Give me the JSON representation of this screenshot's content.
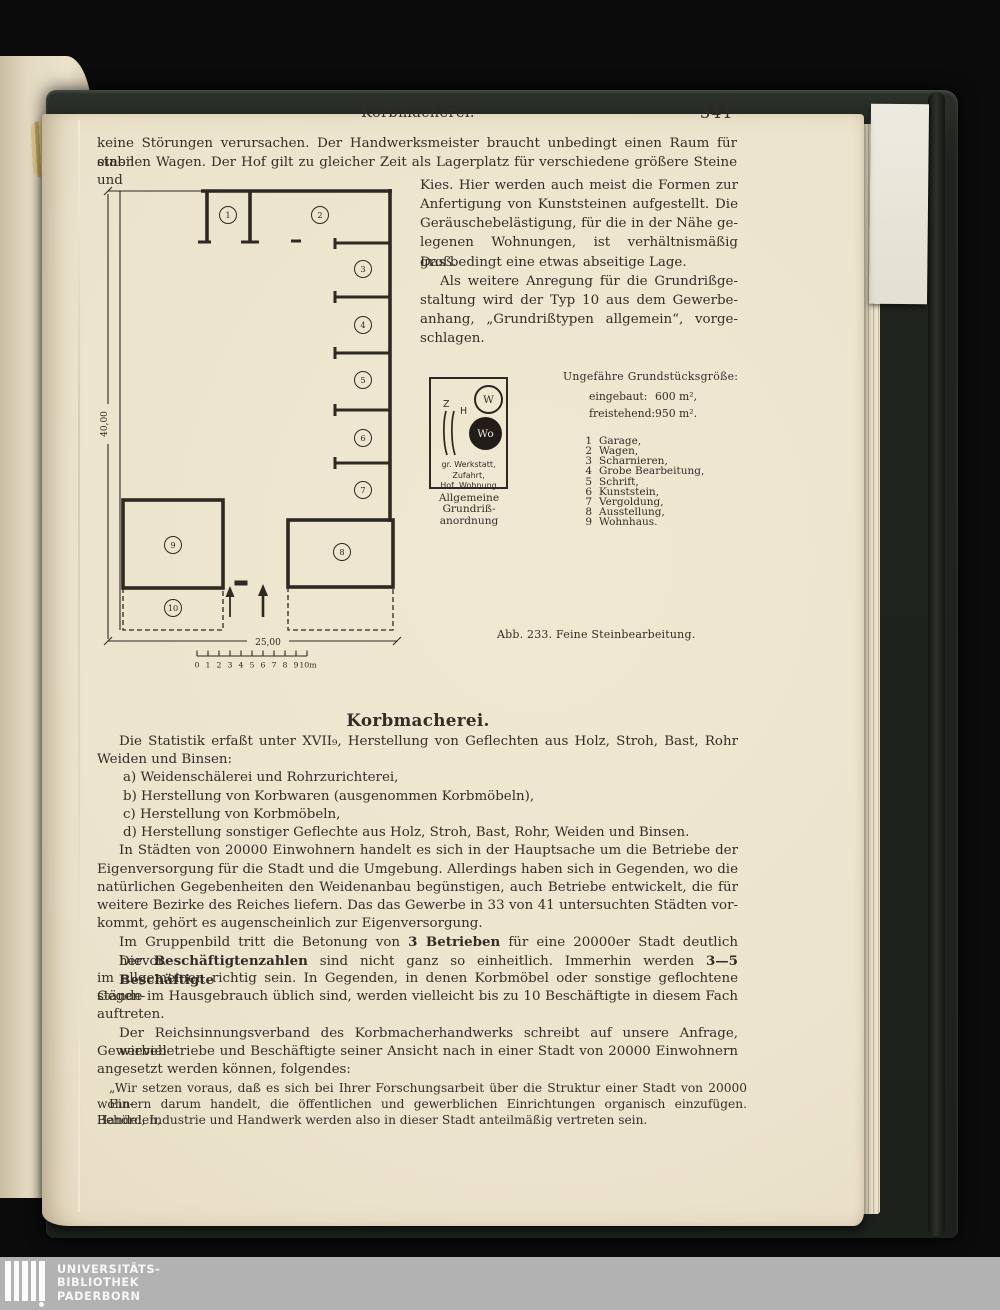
{
  "page": {
    "running_head": "Korbmacherei.",
    "page_number": "341"
  },
  "body": {
    "intro": [
      "keine Störungen verursachen.  Der Handwerksmeister braucht unbedingt einen Raum für einen",
      "stabilen Wagen.  Der Hof gilt zu gleicher Zeit als Lagerplatz für verschiedene größere Steine und"
    ],
    "column": [
      "Kies.  Hier werden auch meist die Formen zur",
      "Anfertigung von Kunststeinen aufgestellt.  Die",
      "Geräuschebelästigung, für die in der Nähe ge-",
      "legenen Wohnungen, ist verhältnismäßig groß.",
      "Das bedingt eine etwas abseitige Lage.",
      "Als weitere Anregung für die Grundrißge-",
      "staltung wird der Typ 10 aus dem Gewerbe-",
      "anhang, „Grundrißtypen allgemein“, vorge-",
      "schlagen."
    ],
    "section_heading": "Korbmacherei.",
    "l1": "Die Statistik erfaßt unter XVII₉, Herstellung von Geflechten aus Holz, Stroh, Bast, Rohr",
    "l2": "Weiden und Binsen:",
    "list_a": "a) Weidenschälerei und Rohrzurichterei,",
    "list_b": "b) Herstellung von Korbwaren (ausgenommen Korbmöbeln),",
    "list_c": "c) Herstellung von Korbmöbeln,",
    "list_d": "d) Herstellung sonstiger Geflechte aus Holz, Stroh, Bast, Rohr, Weiden und Binsen.",
    "p2": [
      "In Städten von 20000 Einwohnern handelt es sich in der Hauptsache um die Betriebe der",
      "Eigenversorgung für die Stadt und die Umgebung.  Allerdings haben sich in Gegenden, wo die",
      "natürlichen Gegebenheiten den Weidenanbau begünstigen, auch Betriebe entwickelt, die für",
      "weitere Bezirke des Reiches liefern.  Das das Gewerbe in 33 von 41 untersuchten Städten vor-",
      "kommt, gehört es augenscheinlich zur Eigenversorgung."
    ],
    "p3": {
      "s1": "Im Gruppenbild tritt die Betonung von ",
      "b1": "3 Betrieben",
      "s2": " für eine 20000er Stadt deutlich hervor."
    },
    "p4l1": {
      "s1": "Die ",
      "b1": "Beschäftigtenzahlen",
      "s2": " sind nicht ganz so einheitlich.  Immerhin werden ",
      "b2": "3—5 Beschäftigte"
    },
    "p4rest": [
      "im allgemeinen richtig sein.  In Gegenden, in denen Korbmöbel oder sonstige geflochtene Gegen-",
      "stände im Hausgebrauch üblich sind, werden vielleicht bis zu 10 Beschäftigte in diesem Fach",
      "auftreten."
    ],
    "p5": [
      "Der Reichsinnungsverband des Korbmacherhandwerks schreibt auf unsere Anfrage, wieviel",
      "Gewerbebetriebe und Beschäftigte seiner Ansicht nach in einer Stadt von 20000 Einwohnern",
      "angesetzt werden können, folgendes:"
    ],
    "quote": [
      "„Wir setzen voraus, daß es sich bei Ihrer Forschungsarbeit über die Struktur einer Stadt von 20000 Ein-",
      "wohnern darum handelt, die öffentlichen und gewerblichen Einrichtungen organisch einzufügen.  Behörden,",
      "Handel, Industrie und Handwerk werden also in dieser Stadt anteilmäßig vertreten sein."
    ]
  },
  "figure": {
    "plan": {
      "height_label": "40,00",
      "width_label": "25,00",
      "rooms": [
        "1",
        "2",
        "3",
        "4",
        "5",
        "6",
        "7",
        "8",
        "9",
        "10"
      ],
      "scale": [
        "0",
        "1",
        "2",
        "3",
        "4",
        "5",
        "6",
        "7",
        "8",
        "9",
        "10m"
      ]
    },
    "legend_box": {
      "z": "Z",
      "h": "H",
      "w": "W",
      "wo": "Wo",
      "caption1": "gr. Werkstatt, Zufahrt,",
      "caption2": "Hof, Wohnung",
      "title1": "Allgemeine",
      "title2": "Grundriß-",
      "title3": "anordnung"
    },
    "plot_info": {
      "title": "Ungefähre Grundstücksgröße:",
      "row1_label": "eingebaut:",
      "row1_value": "600 m²,",
      "row2_label": "freistehend:",
      "row2_value": "950 m²."
    },
    "legend_items": [
      {
        "num": "1",
        "label": "Garage,"
      },
      {
        "num": "2",
        "label": "Wagen,"
      },
      {
        "num": "3",
        "label": "Scharnieren,"
      },
      {
        "num": "4",
        "label": "Grobe Bearbeitung,"
      },
      {
        "num": "5",
        "label": "Schrift,"
      },
      {
        "num": "6",
        "label": "Kunststein,"
      },
      {
        "num": "7",
        "label": "Vergoldung,"
      },
      {
        "num": "8",
        "label": "Ausstellung,"
      },
      {
        "num": "9",
        "label": "Wohnhaus."
      }
    ],
    "caption": "Abb. 233.  Feine Steinbearbeitung."
  },
  "watermark": {
    "line1": "UNIVERSITÄTS-",
    "line2": "BIBLIOTHEK",
    "line3": "PADERBORN"
  },
  "colors": {
    "page": "#ece3cc",
    "ink": "#332d25",
    "cover": "#20241e",
    "background": "#0b0b0b",
    "band": "#b2b2b2"
  }
}
